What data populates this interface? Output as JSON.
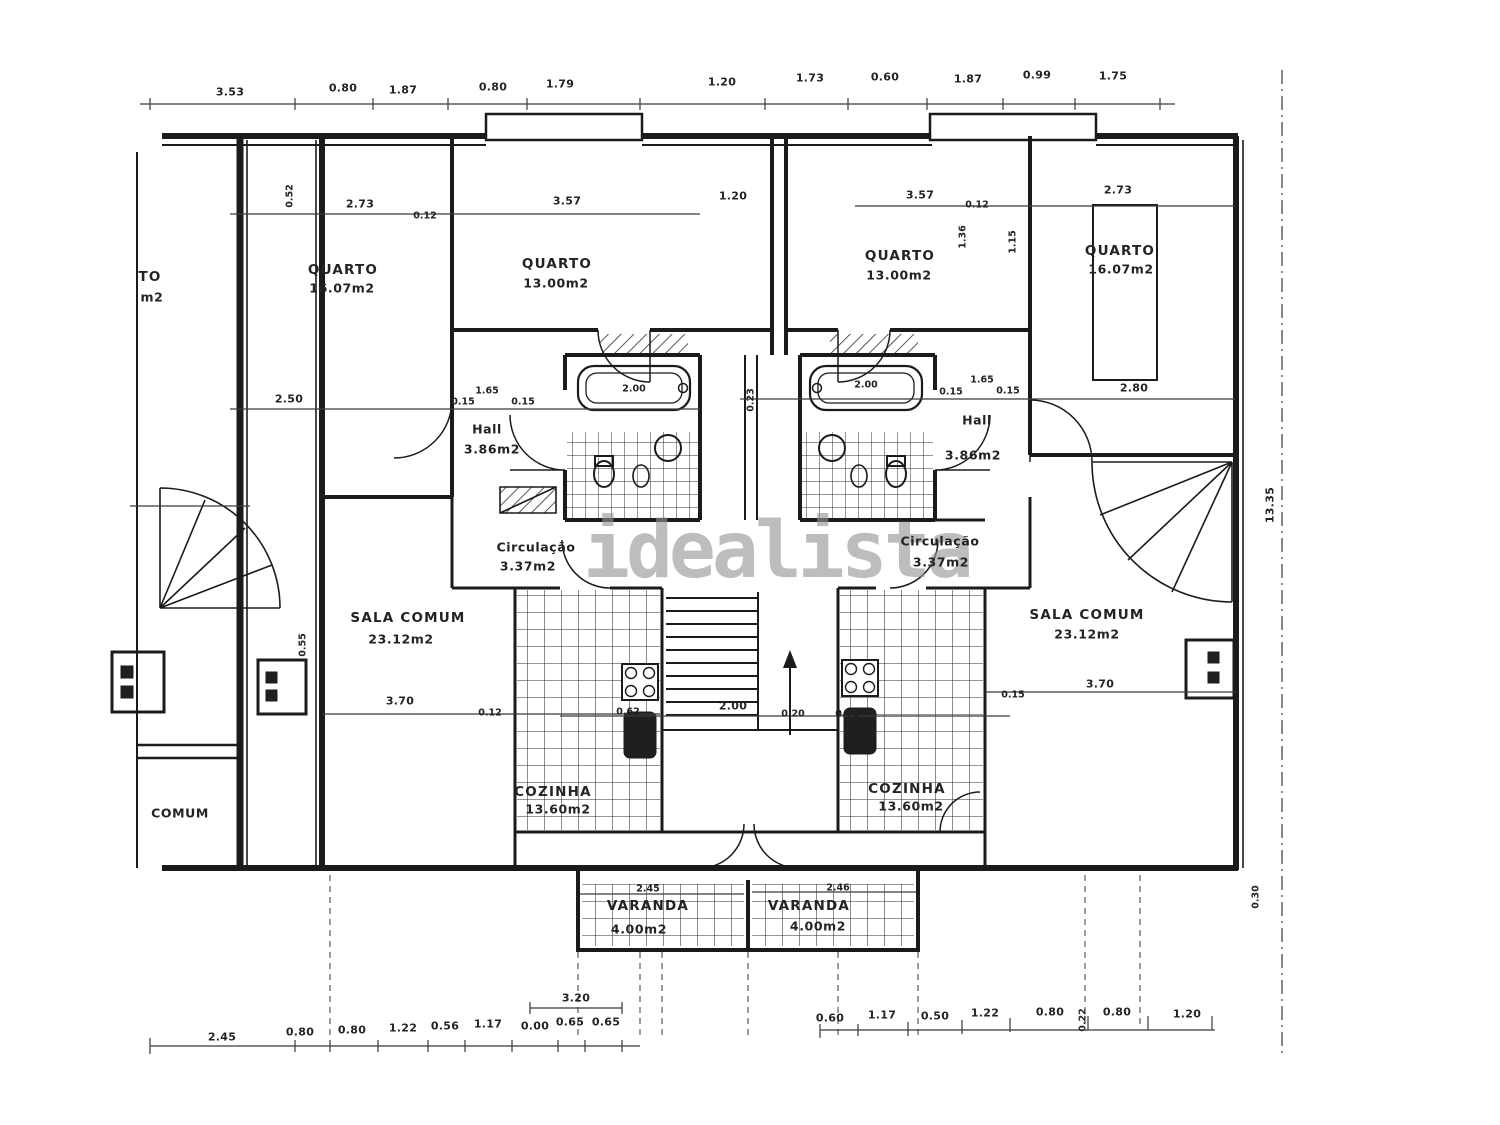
{
  "watermark": {
    "text": "idealista"
  },
  "rooms": {
    "partial": {
      "l1": "TO",
      "l2": "m2",
      "l3": "COMUM"
    },
    "q16l": {
      "name": "QUARTO",
      "area": "16.07m2"
    },
    "q13l": {
      "name": "QUARTO",
      "area": "13.00m2"
    },
    "q13r": {
      "name": "QUARTO",
      "area": "13.00m2"
    },
    "q16r": {
      "name": "QUARTO",
      "area": "16.07m2"
    },
    "hall_l": {
      "name": "Hall",
      "area": "3.86m2"
    },
    "hall_r": {
      "name": "Hall",
      "area": "3.86m2"
    },
    "circ_l": {
      "name": "Circulação",
      "area": "3.37m2"
    },
    "circ_r": {
      "name": "Circulação",
      "area": "3.37m2"
    },
    "sala_l": {
      "name": "SALA COMUM",
      "area": "23.12m2"
    },
    "sala_r": {
      "name": "SALA COMUM",
      "area": "23.12m2"
    },
    "coz_l": {
      "name": "COZINHA",
      "area": "13.60m2"
    },
    "coz_r": {
      "name": "COZINHA",
      "area": "13.60m2"
    },
    "var_l": {
      "name": "VARANDA",
      "area": "4.00m2"
    },
    "var_r": {
      "name": "VARANDA",
      "area": "4.00m2"
    }
  },
  "dims": {
    "top": [
      "3.53",
      "0.80",
      "1.87",
      "0.80",
      "1.79",
      "1.20",
      "1.73",
      "0.60",
      "1.87",
      "0.99",
      "1.75"
    ],
    "upper_left": [
      "2.73",
      "0.12",
      "3.57"
    ],
    "upper_center": "1.20",
    "upper_right": [
      "3.57",
      "0.12",
      "2.73"
    ],
    "upper_rot": [
      "0.52",
      "1.36",
      "1.15"
    ],
    "mid": {
      "left": "2.50",
      "hl1": "0.15",
      "hl2": "1.65",
      "hl3": "0.15",
      "tub_l": "2.00",
      "gap": "0.23",
      "tub_r": "2.00",
      "hr1": "0.15",
      "hr2": "1.65",
      "hr3": "0.15",
      "closet": "2.80"
    },
    "lower": [
      "3.70",
      "0.12",
      "0.62",
      "2.00",
      "0.20",
      "0.62",
      "0.15",
      "3.70"
    ],
    "balcony": {
      "left": "2.45",
      "right": "2.46",
      "center": "3.20"
    },
    "bottom": [
      "2.45",
      "0.80",
      "0.80",
      "1.22",
      "0.56",
      "1.17",
      "0.00",
      "0.65",
      "0.65",
      "0.60",
      "1.17",
      "0.50",
      "1.22",
      "0.80",
      "0.80",
      "1.20"
    ],
    "edge": {
      "right": "13.35",
      "right_low": "0.30",
      "left_rot": "0.55",
      "rot_small": "0.22"
    }
  }
}
